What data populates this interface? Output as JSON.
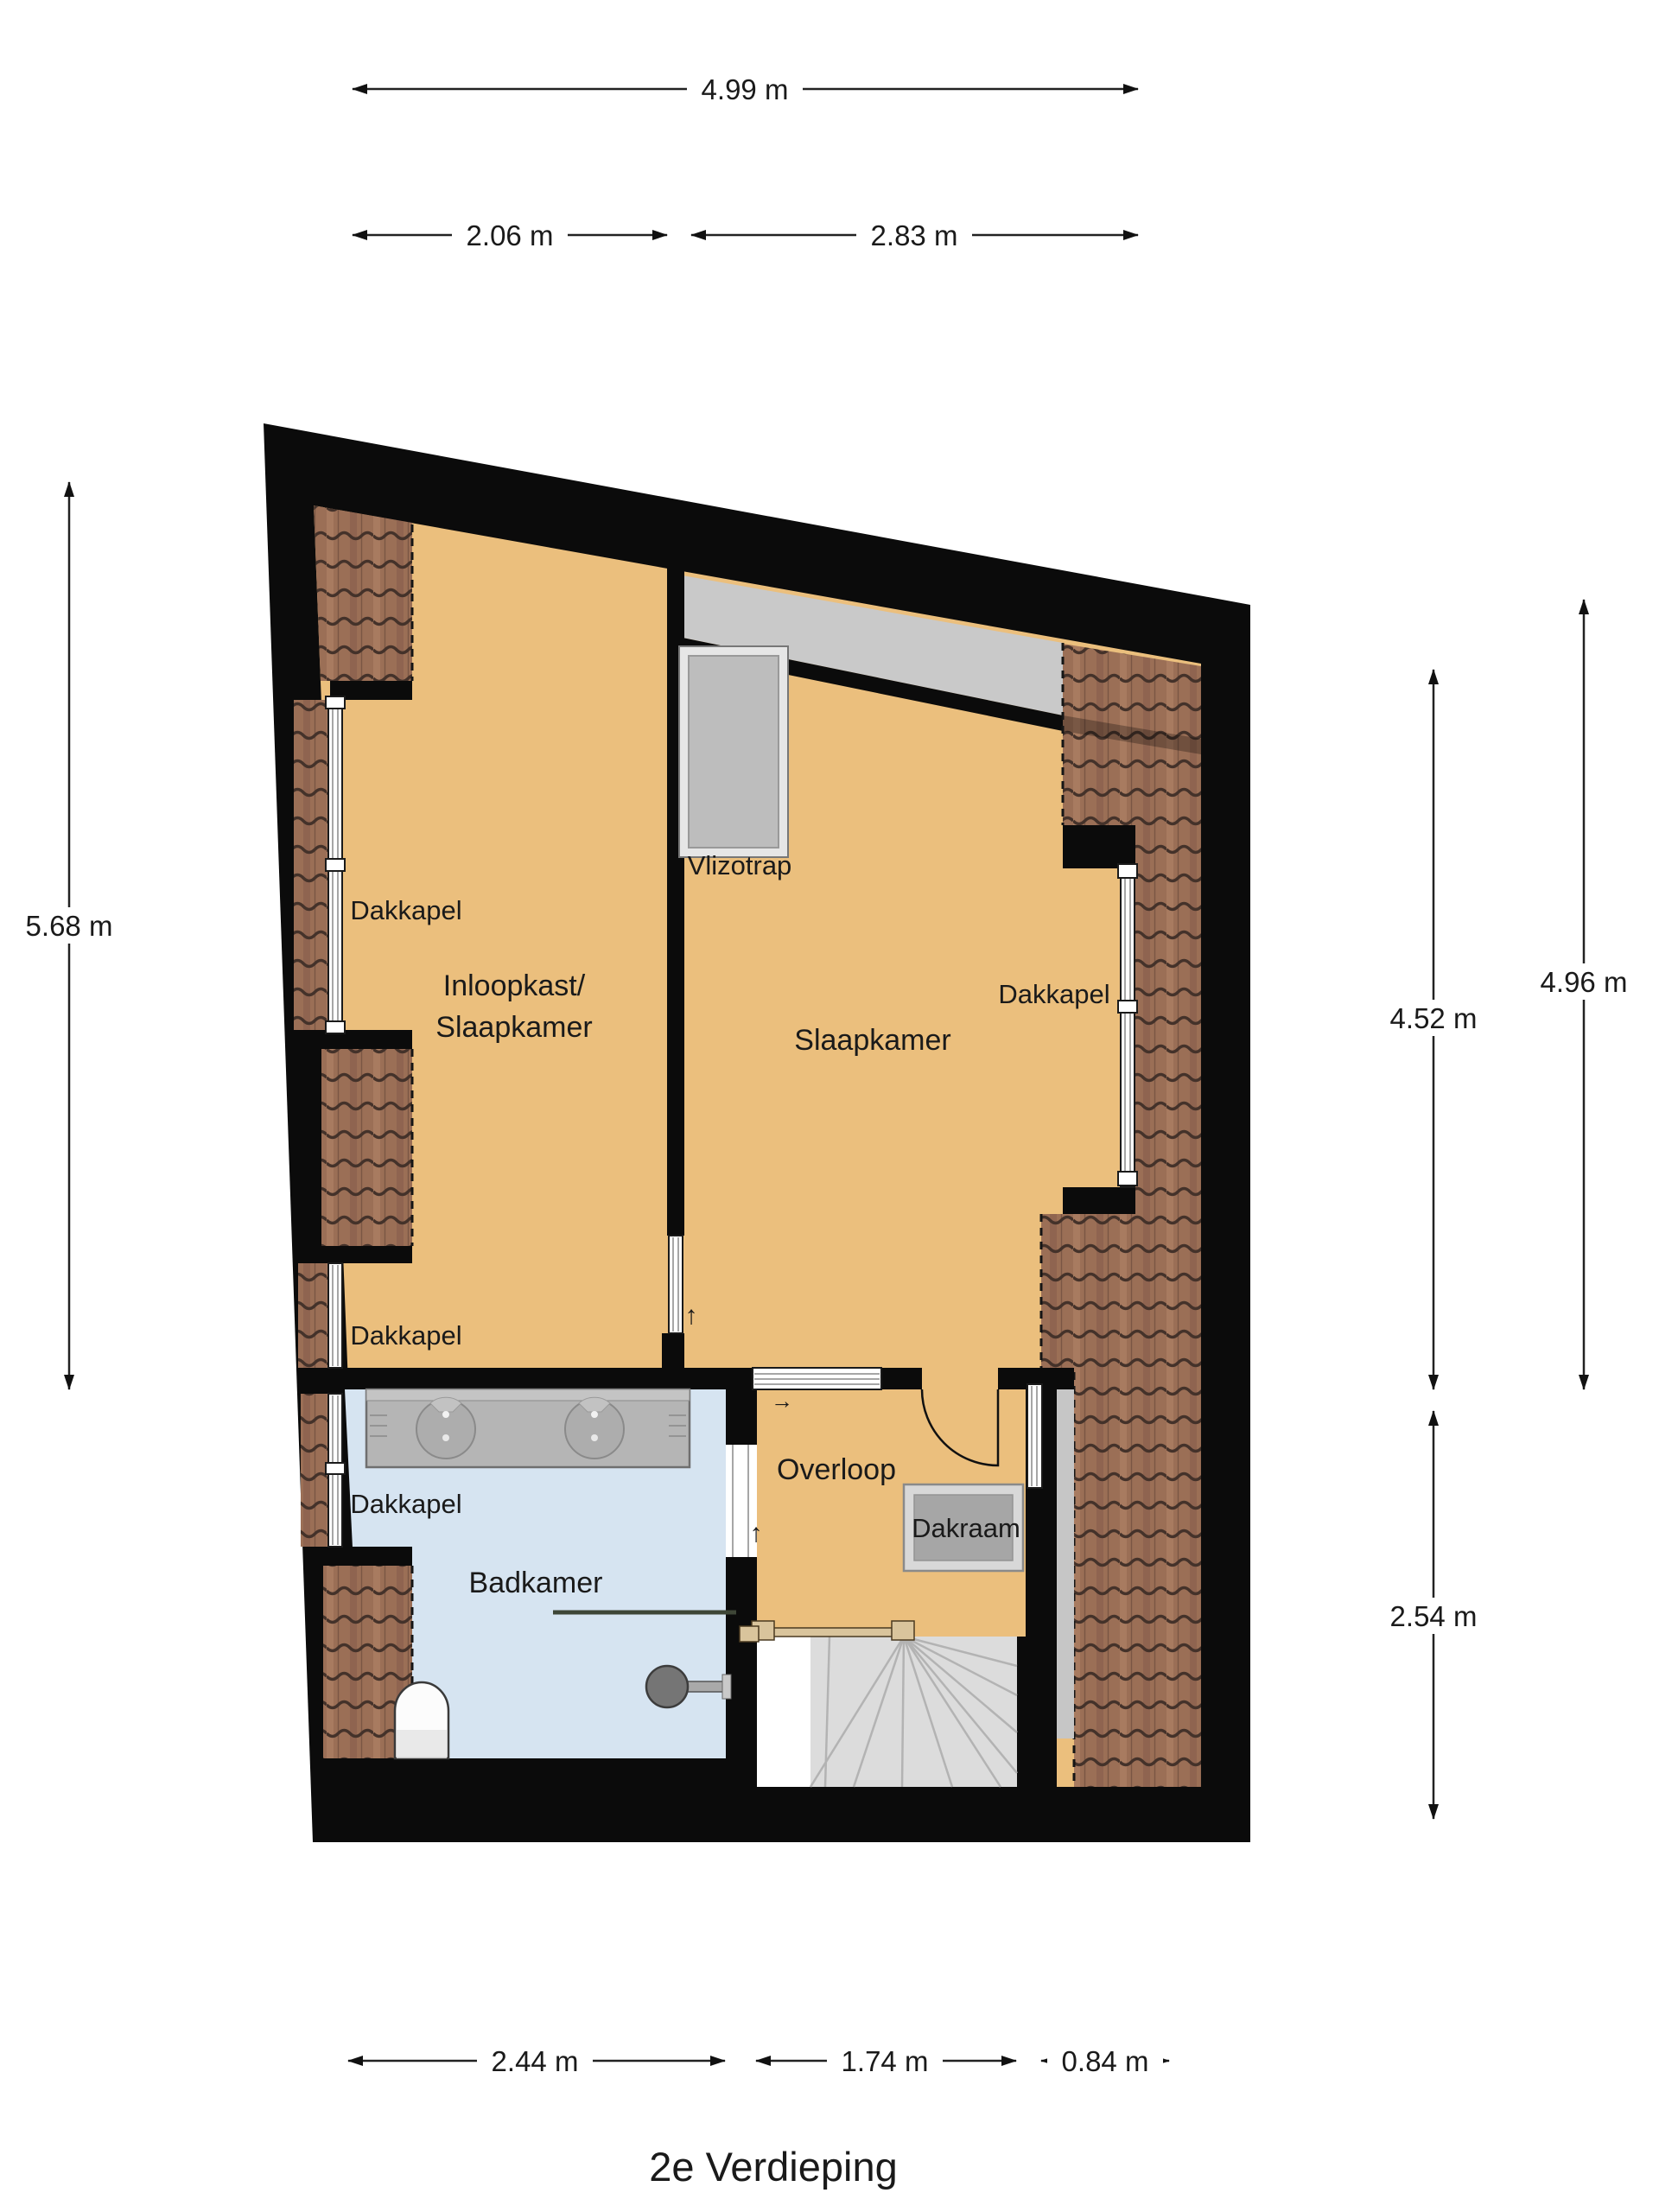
{
  "title": "2e Verdieping",
  "rooms": {
    "inloopkast_l1": "Inloopkast/",
    "inloopkast_l2": "Slaapkamer",
    "slaapkamer": "Slaapkamer",
    "badkamer": "Badkamer",
    "overloop": "Overloop"
  },
  "features": {
    "vlizotrap": "Vlizotrap",
    "dakraam": "Dakraam",
    "dakkapel_left_top": "Dakkapel",
    "dakkapel_left_mid": "Dakkapel",
    "dakkapel_left_bottom": "Dakkapel",
    "dakkapel_right": "Dakkapel"
  },
  "dimensions": {
    "top_total": "4.99 m",
    "top_left": "2.06 m",
    "top_right": "2.83 m",
    "left_height": "5.68 m",
    "right_inner": "4.52 m",
    "right_outer": "4.96 m",
    "right_lower": "2.54 m",
    "bottom_left": "2.44 m",
    "bottom_middle": "1.74 m",
    "bottom_right": "0.84 m"
  },
  "icons": {
    "stairs_up_arrow": "↑",
    "door_direction_arrow": "→",
    "bedroom_door_arrow": "↑"
  },
  "colors": {
    "wall": "#0B0B0B",
    "floor_orange": "#EBBF7D",
    "floor_blue": "#D6E4F1",
    "roof_tile": "#9B6F56",
    "sloped_ceiling_gray": "#C9C9C9",
    "stairs_gray": "#DCDCDC",
    "fixture_gray": "#B5B5B5"
  }
}
